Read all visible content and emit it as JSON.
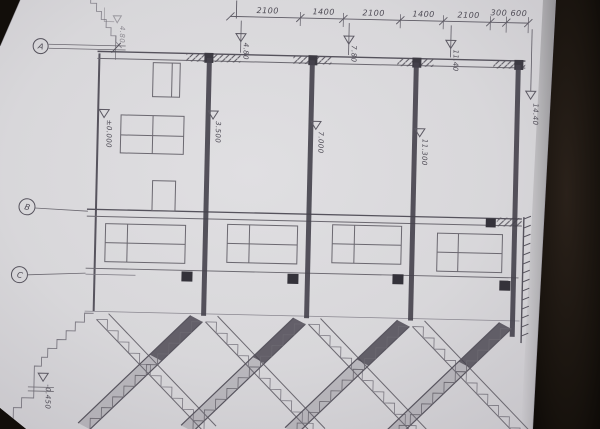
{
  "scene": {
    "kind": "photo of hand-drawn pencil architectural section drawing",
    "background_color": "#17120d",
    "paper_color": "#d8d7da",
    "pencil_color": "#5f5c66"
  },
  "dimensions": {
    "top_chain": [
      "2100",
      "1400",
      "2100",
      "1400",
      "2100",
      "300",
      "600"
    ]
  },
  "levels": {
    "top": [
      "4.80",
      "7.80",
      "11.40"
    ],
    "right": "14.40",
    "left_upper": "4.80",
    "mid": [
      "±0.000",
      "3.500",
      "7.000",
      "11.300"
    ],
    "bottom": "-0.450"
  },
  "grid_bubbles": [
    "A",
    "B",
    "C"
  ]
}
